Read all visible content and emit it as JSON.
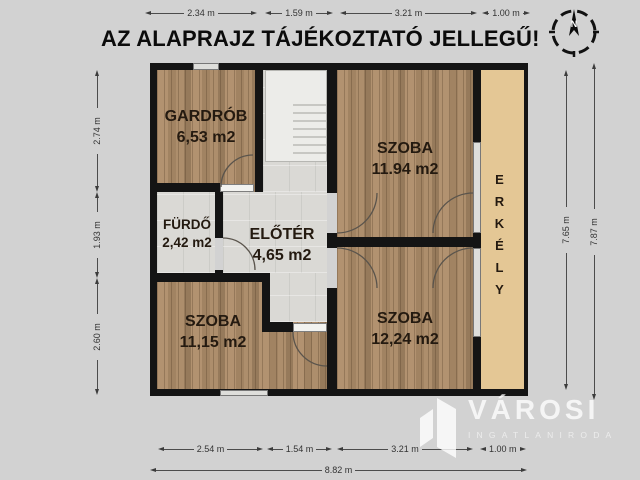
{
  "title": "AZ ALAPRAJZ TÁJÉKOZTATÓ JELLEGŰ!",
  "compass": {
    "north_label": "N"
  },
  "rooms": {
    "gardrob": {
      "name": "GARDRÓB",
      "area": "6,53 m2"
    },
    "furdo": {
      "name": "FÜRDŐ",
      "area": "2,42 m2"
    },
    "eloter": {
      "name": "ELŐTÉR",
      "area": "4,65 m2"
    },
    "szoba_top_right": {
      "name": "SZOBA",
      "area": "11.94 m2"
    },
    "szoba_bottom_left": {
      "name": "SZOBA",
      "area": "11,15 m2"
    },
    "szoba_bottom_right": {
      "name": "SZOBA",
      "area": "12,24 m2"
    },
    "erkely": {
      "name": "ERKÉLY"
    }
  },
  "dimensions": {
    "top": [
      "2.34 m",
      "1.59 m",
      "3.21 m",
      "1.00 m"
    ],
    "left": [
      "2.74 m",
      "1.93 m",
      "2.60 m"
    ],
    "right_inner": "7.65 m",
    "right_outer": "7.87 m",
    "bottom": [
      "2.54 m",
      "1.54 m",
      "3.21 m",
      "1.00 m"
    ],
    "bottom_total": "8.82 m"
  },
  "watermark": {
    "brand": "VÁROSI",
    "subtitle": "INGATLANIRODA"
  },
  "colors": {
    "background": "#d2d2d2",
    "wall": "#141414",
    "wood_floor": "#a78a66",
    "tile_floor": "#dad9d5",
    "balcony": "#e4c795",
    "watermark": "#ffffff"
  }
}
